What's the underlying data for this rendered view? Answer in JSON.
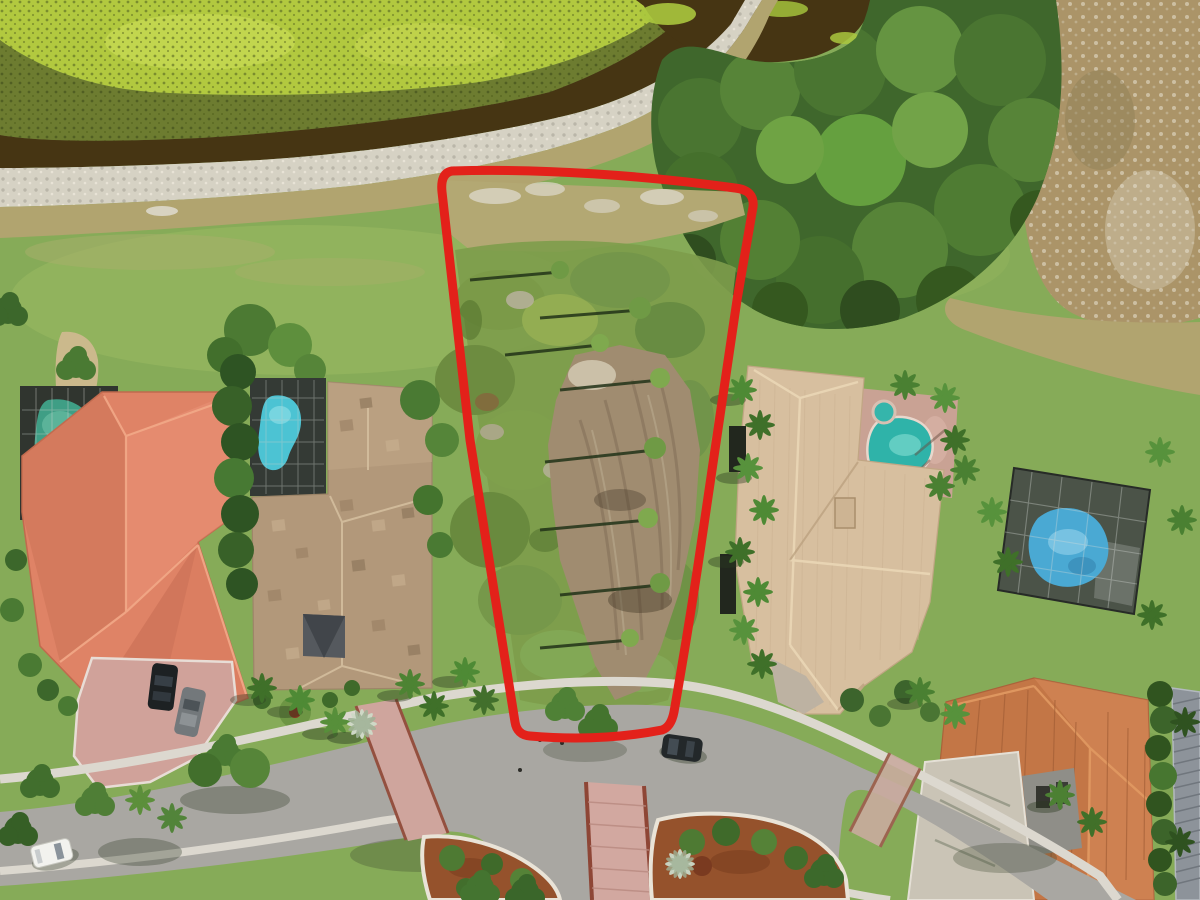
{
  "image": {
    "kind": "aerial drone photograph",
    "description": "Overhead aerial photo of a vacant residential building lot outlined in thick red, situated between large single-family homes, fronting a curved suburban street with landscaped median islands, and backing to a canal and green preserve",
    "width_px": 1200,
    "height_px": 900
  },
  "lot": {
    "outline_color": "#e3211a",
    "outline_shape": "four-sided parcel, wider at the canal side, rounded corners, street frontage at bottom",
    "contents": [
      "dry tan grass near canal",
      "low scrub vegetation",
      "thin trees casting long shadows",
      "cleared bare-dirt pad",
      "public sidewalk crossing the frontage"
    ]
  },
  "waterfront": {
    "algae_mat_color": "#b2c93f",
    "sawgrass_band_color": "#6d7c30",
    "canal_water_color": "#463513",
    "rocky_shore_color": "#d6d2c4",
    "dry_bank_color": "#b1a46f",
    "preserve_marsh_color": "#ab9468",
    "tree_canopy_color": "#4a7531"
  },
  "neighborhood": {
    "lawn_color": "#86ab58",
    "houses": [
      {
        "position": "far left",
        "roof_color": "#df8366",
        "roof_type": "coral tile hip roof",
        "pool": {
          "screened": true,
          "water_color": "#3f9e85"
        }
      },
      {
        "position": "immediately left of lot",
        "roof_color": "#b2987a",
        "roof_type": "mottled tan flat tile",
        "pool": {
          "screened": true,
          "water_color": "#4cc3d3"
        }
      },
      {
        "position": "immediately right of lot",
        "roof_color": "#d7bf9f",
        "roof_type": "light sand tile",
        "pool": {
          "screened": false,
          "water_color": "#2fb3a9",
          "spa": true
        }
      },
      {
        "position": "bottom right",
        "roof_color": "#c97c4b",
        "roof_type": "terracotta tile",
        "pool": {
          "screened": true,
          "water_color": "#4aa9d3"
        }
      },
      {
        "position": "right edge, partially visible",
        "roof_color": "#8d939a",
        "roof_type": "gray metal slat roof"
      }
    ],
    "road": {
      "surface_color": "#a9a7a2",
      "sidewalk_color": "#dcd8cf",
      "paver_crossing_color": "#d2a8a0",
      "paver_border_color": "#8e4636",
      "median_mulch_color": "#95522c",
      "median_curb_color": "#e9e3d7"
    },
    "vehicles": [
      {
        "type": "car",
        "color": "white",
        "location": "parked on street, lower left"
      },
      {
        "type": "suv",
        "color": "dark green-black",
        "location": "parked on street at lot frontage"
      },
      {
        "type": "car",
        "color": "black",
        "location": "driveway of far-left house"
      },
      {
        "type": "car",
        "color": "gray",
        "location": "driveway of far-left house"
      }
    ],
    "landscaping": [
      "palm trees",
      "clipped hedges",
      "red mulch island beds",
      "golf-style lawns",
      "sand path",
      "silver-green palm specimen"
    ]
  }
}
